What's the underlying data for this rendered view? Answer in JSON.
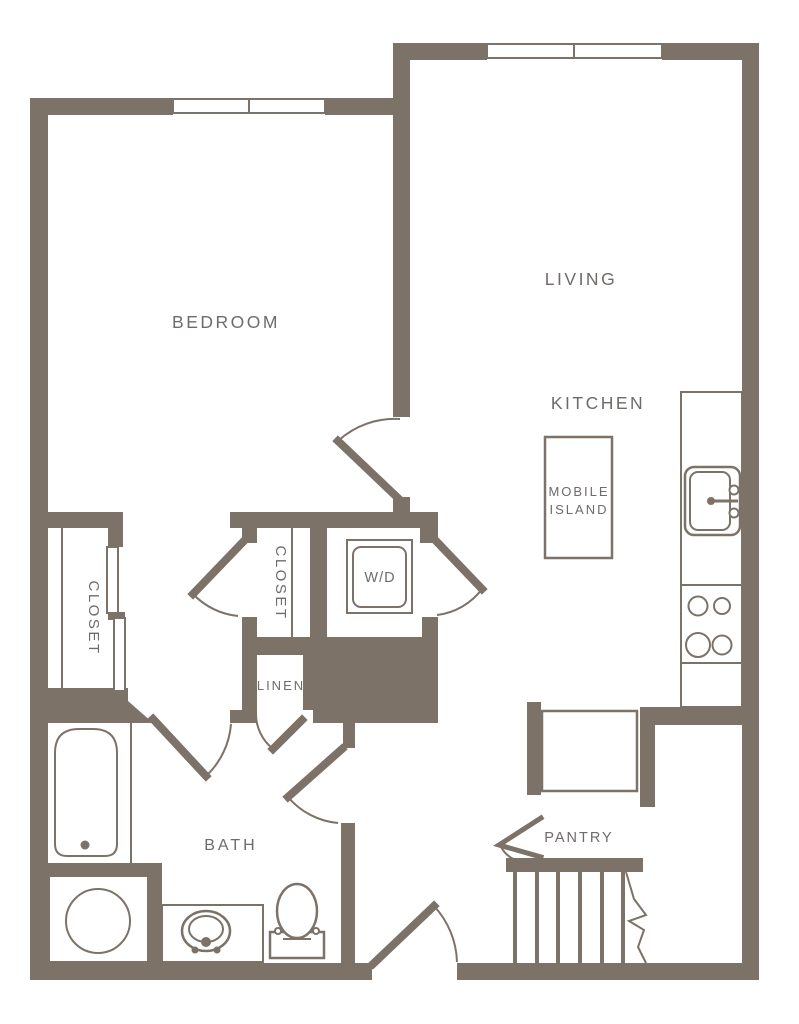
{
  "floorplan": {
    "colors": {
      "wall": "#7c7268",
      "fixture_line": "#7c7268",
      "label_text": "#6f6b69",
      "background": "#ffffff"
    },
    "labels": {
      "bedroom": "BEDROOM",
      "living": "LIVING",
      "kitchen": "KITCHEN",
      "mobile_island_line1": "MOBILE",
      "mobile_island_line2": "ISLAND",
      "closet_left": "CLOSET",
      "closet_hall": "CLOSET",
      "washer_dryer": "W/D",
      "linen": "LINEN",
      "bath": "BATH",
      "pantry": "PANTRY"
    }
  }
}
